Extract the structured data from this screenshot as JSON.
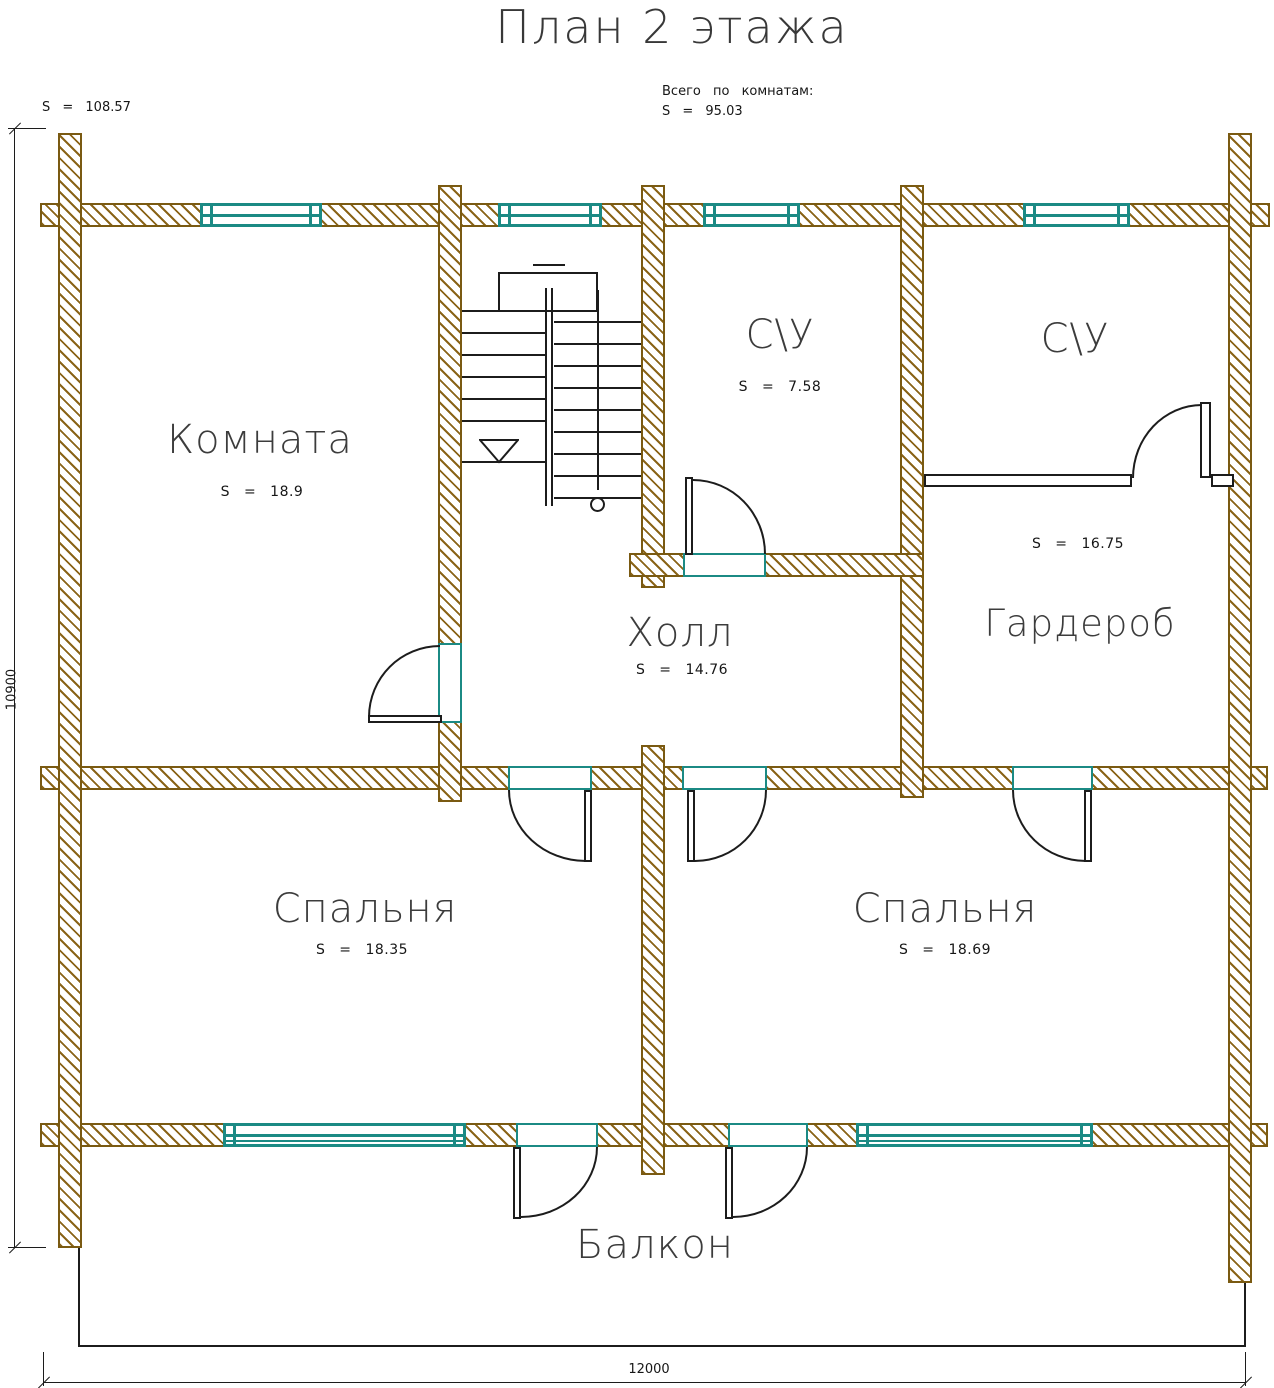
{
  "title": "План 2 этажа",
  "annotations": {
    "total_by_rooms_label": "Всего по комнатам:",
    "total_by_rooms_value": "S = 95.03",
    "floor_area": "S = 108.57"
  },
  "dimensions": {
    "bottom": "12000",
    "left": "10900"
  },
  "rooms": {
    "komnata": {
      "name": "Комната",
      "area": "S = 18.9"
    },
    "su_left": {
      "name": "С\\У",
      "area": "S = 7.58"
    },
    "su_right": {
      "name": "С\\У"
    },
    "garderob": {
      "name": "Гардероб",
      "area": "S = 16.75"
    },
    "holl": {
      "name": "Холл",
      "area": "S = 14.76"
    },
    "spalnya_left": {
      "name": "Спальня",
      "area": "S = 18.35"
    },
    "spalnya_right": {
      "name": "Спальня",
      "area": "S = 18.69"
    },
    "balkon": {
      "name": "Балкон"
    }
  },
  "colors": {
    "wall_outline": "#7a5a12",
    "wall_hatch": "#8a6418",
    "window": "#1b8a84",
    "line": "#1c1c1c"
  }
}
